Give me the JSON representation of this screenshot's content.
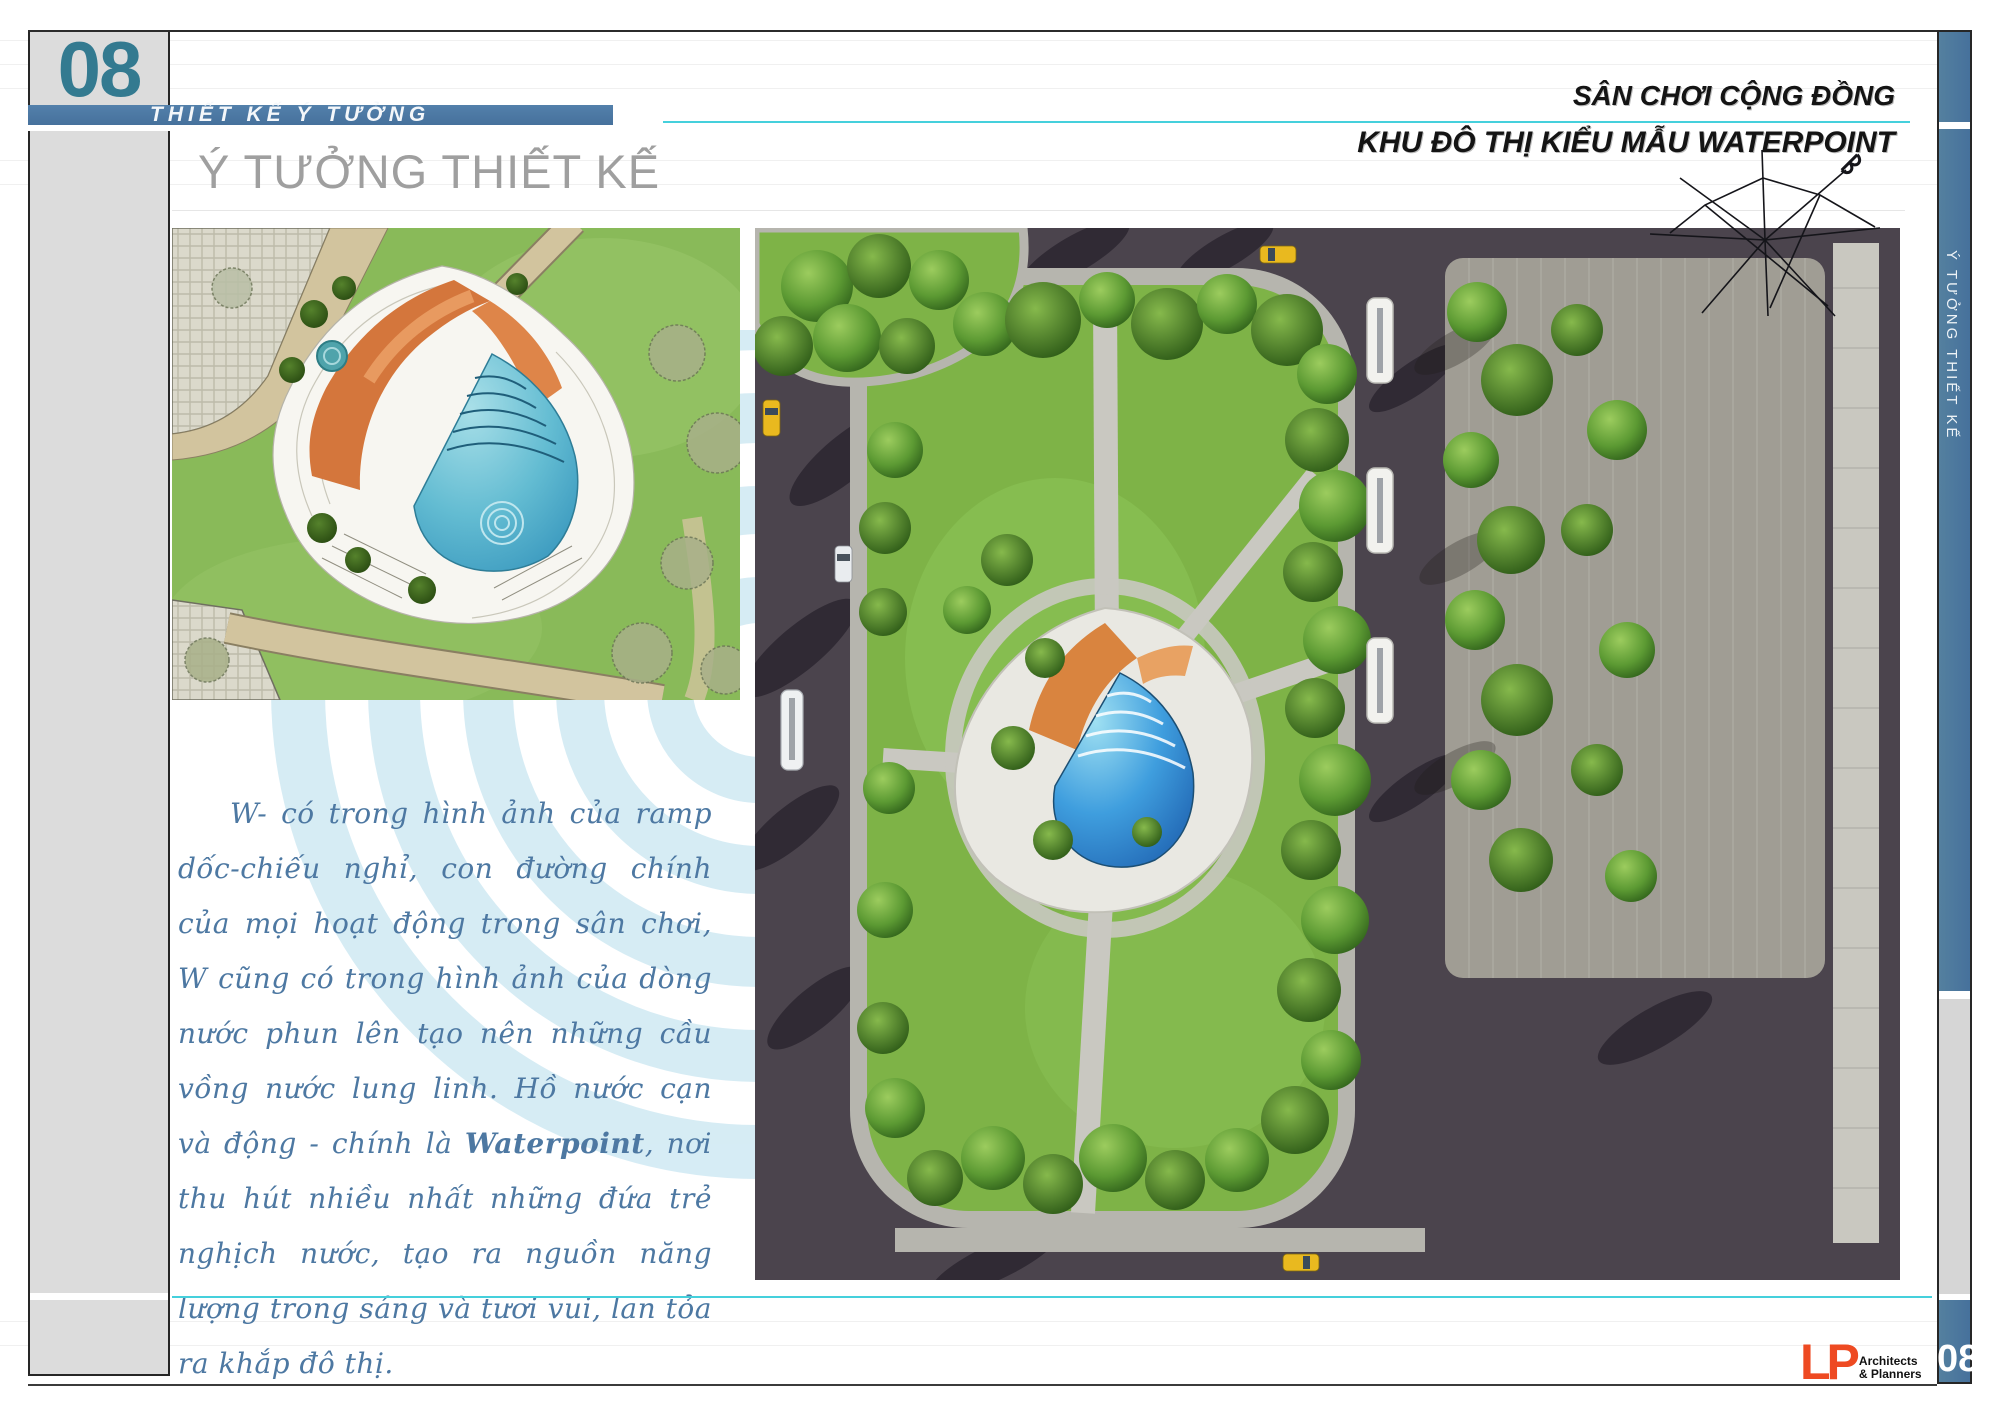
{
  "page": {
    "number_top": "08",
    "number_bottom": "08",
    "section_band_label": "THIẾT KẾ Ý TƯỞNG",
    "title": "Ý TƯỞNG THIẾT KẾ",
    "sidebar_vertical_label": "Ý TƯỞNG THIẾT KẾ"
  },
  "header": {
    "line1": "SÂN CHƠI CỘNG ĐỒNG",
    "line2": "KHU ĐÔ THỊ KIỂU MẪU WATERPOINT"
  },
  "body_text": {
    "part1": "W- có trong hình ảnh của ramp dốc-chiếu nghỉ, con đường chính của mọi hoạt động trong sân chơi, W cũng có trong hình ảnh của dòng nước phun lên tạo nên những cầu vồng nước lung linh. Hồ nước cạn và động - chính là ",
    "highlight": "Waterpoint",
    "part2": ", nơi thu hút nhiều nhất những đứa trẻ nghịch nước, tạo ra nguồn năng lượng trong sáng và tươi vui, lan tỏa ra khắp đô thị."
  },
  "logo": {
    "mark": "LP",
    "line1": "Architects",
    "line2": "& Planners"
  },
  "figures": {
    "plan": "watercolor concept site plan with terraced mound, orange ramps and fan-shaped water pool",
    "render": "aerial 3d render of community playground block with tree ring, lawns, roads, buses and taxis",
    "compass": "north-arrow sketch icon",
    "ripples": "concentric water-ripple background graphic"
  },
  "colors": {
    "accent_blue_band": "#46719c",
    "accent_cyan_line": "#45d0dc",
    "page_number_teal": "#337a90",
    "body_text_blue": "#4d78a2",
    "logo_orange": "#ee4a22",
    "title_gray": "#9f9f9f"
  }
}
